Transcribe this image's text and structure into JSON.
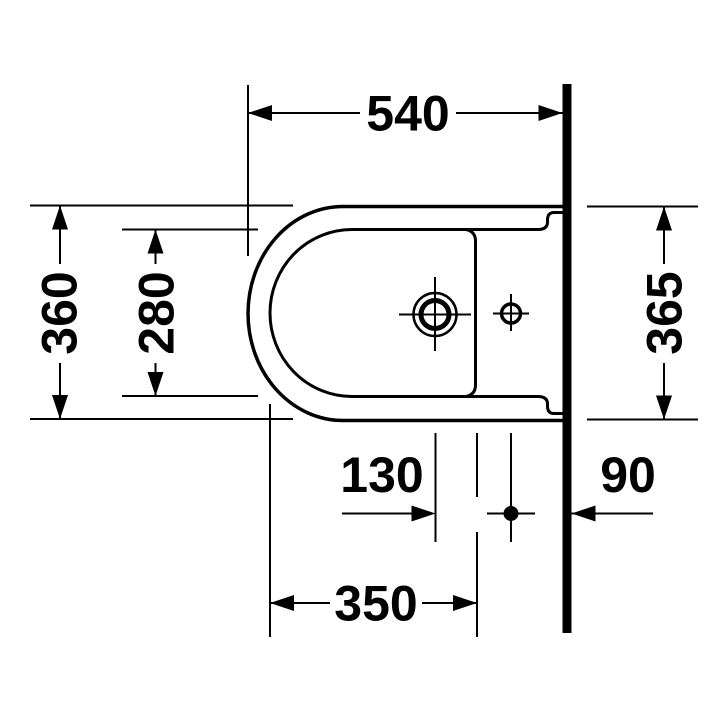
{
  "drawing": {
    "kind": "bidet-top-view-dimension-drawing",
    "ink_color": "#000000",
    "background_color": "#ffffff",
    "dims": {
      "overall_depth": "540",
      "front_width": "360",
      "inner_basin_width": "280",
      "wall_width": "365",
      "hole_spacing": "130",
      "wall_to_hole": "90",
      "front_to_hole": "350"
    }
  }
}
